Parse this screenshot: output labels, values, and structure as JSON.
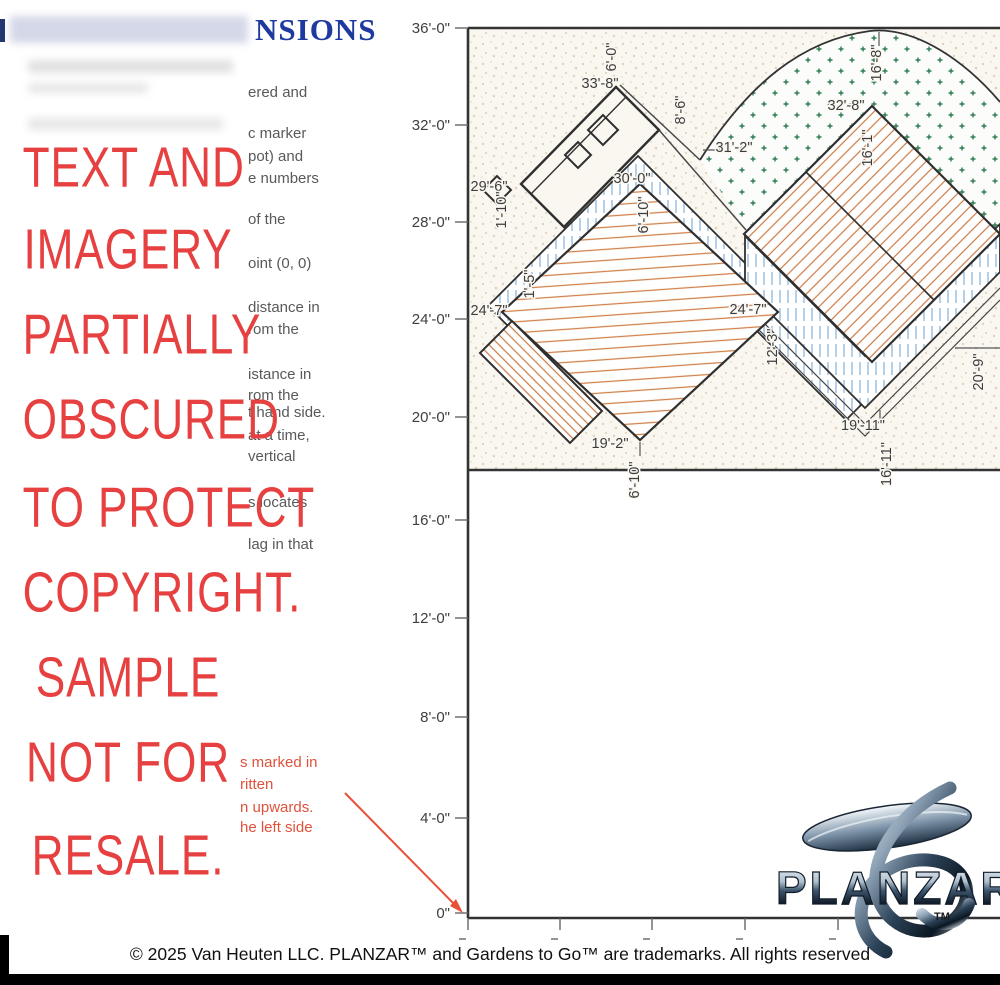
{
  "header": {
    "title_fragment": "NSIONS",
    "title_color": "#1e3a9e"
  },
  "watermark": {
    "color": "#e64040",
    "lines": [
      "TEXT AND",
      "IMAGERY",
      "PARTIALLY",
      "OBSCURED",
      "TO PROTECT",
      "COPYRIGHT.",
      "SAMPLE",
      "NOT FOR",
      "RESALE."
    ]
  },
  "instructions": {
    "color": "#595959",
    "fragments": [
      "ered and",
      "c marker",
      "pot) and",
      "e numbers",
      "of the",
      "oint (0, 0)",
      "distance in",
      "rom the",
      "istance in",
      "rom the",
      "t hand side.",
      "at a time,",
      "vertical",
      "s locates",
      "lag in that"
    ]
  },
  "red_notes": {
    "color": "#e0523c",
    "fragments": [
      "s marked in",
      "ritten",
      "n upwards.",
      "he left side"
    ]
  },
  "plan": {
    "y_axis_labels": [
      "36'-0\"",
      "32'-0\"",
      "28'-0\"",
      "24'-0\"",
      "20'-0\"",
      "16'-0\"",
      "12'-0\"",
      "8'-0\"",
      "4'-0\"",
      "0\""
    ],
    "dims": [
      "33'-8\"",
      "6'-0\"",
      "8'-6\"",
      "31'-2\"",
      "29'-6\"",
      "1'-10\"",
      "30'-0\"",
      "6'-10\"",
      "32'-8\"",
      "16'-8\"",
      "16'-1\"",
      "24'-7\"",
      "1'-5\"",
      "24'-7\"",
      "12'-3\"",
      "19'-2\"",
      "6'-10\"",
      "19'-11\"",
      "16'-11\"",
      "20'-9\""
    ],
    "colors": {
      "outline": "#2f2f2f",
      "deck_hatch": "#d08048",
      "bed_hatch": "#a9c7e4",
      "groundcover_marks": "#2f7c52",
      "stipple": "#d3c3a8"
    }
  },
  "logo": {
    "name": "PLANZAR",
    "tm": "TM"
  },
  "footer": {
    "copyright": "© 2025 Van Heuten LLC. PLANZAR™ and Gardens to Go™ are trademarks. All rights reserved"
  }
}
